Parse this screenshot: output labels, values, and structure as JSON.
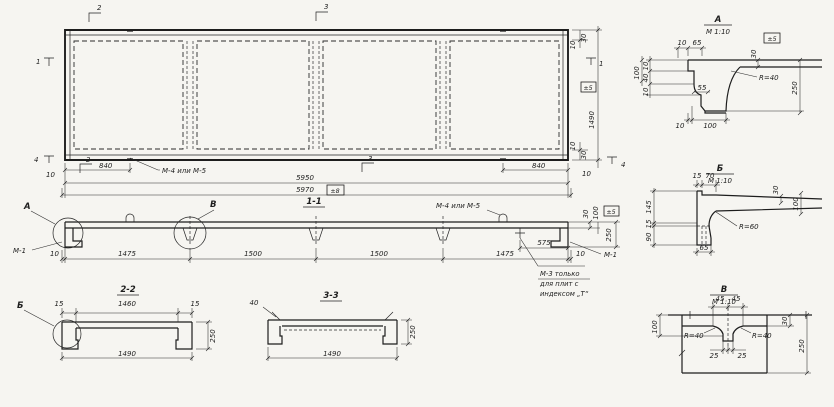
{
  "meta": {
    "drawing_type": "precast ribbed slab working drawing",
    "paper_color": "#f6f5f1",
    "ink_color": "#1e1e1e"
  },
  "plan": {
    "marker_top_2": "2",
    "marker_top_3": "3",
    "marker_bottom_2": "2",
    "marker_bottom_3": "3",
    "marker_left_1": "1",
    "marker_left_4": "4",
    "marker_right_1": "1",
    "marker_right_4": "4",
    "dim_edge_left": "10",
    "dim_840_left": "840",
    "dim_5950": "5950",
    "dim_5970": "5970",
    "tol_5970": "±8",
    "dim_840_right": "840",
    "dim_edge_right": "10",
    "dim_30_top": "30",
    "dim_10_top": "10",
    "dim_1490": "1490",
    "tol_1490": "±5",
    "dim_10_bottom": "10",
    "dim_30_bottom": "30",
    "label_m4m5": "М-4 или М-5"
  },
  "section_1_1": {
    "title": "1-1",
    "detail_ref_a": "А",
    "detail_ref_v": "В",
    "label_m1_left": "М-1",
    "label_m1_right": "М-1",
    "label_m4m5": "М-4 или М-5",
    "note_m3_line1": "М-3 только",
    "note_m3_line2": "для плит с",
    "note_m3_line3": "индексом „Т“",
    "dim_10_left": "10",
    "chain": [
      "1475",
      "1500",
      "1500",
      "1475"
    ],
    "dim_575": "575",
    "dim_10_right": "10",
    "dim_30": "30",
    "dim_100": "100",
    "tol_5": "±5",
    "dim_250": "250"
  },
  "section_2_2": {
    "title": "2-2",
    "detail_ref_b": "Б",
    "dim_15_left": "15",
    "dim_1460": "1460",
    "dim_15_right": "15",
    "dim_250": "250",
    "dim_1490": "1490"
  },
  "section_3_3": {
    "title": "3-3",
    "dim_40": "40",
    "dim_1490": "1490",
    "dim_250": "250"
  },
  "detail_a": {
    "title": "А",
    "scale": "М 1:10",
    "tol": "±5",
    "dim_10_top": "10",
    "dim_65": "65",
    "dim_30": "30",
    "radius": "R=40",
    "dim_100_left": "100",
    "dim_10_a": "10",
    "dim_40": "40",
    "dim_10_b": "10",
    "dim_55": "55",
    "dim_10_bottom": "10",
    "dim_100_bottom": "100",
    "dim_250": "250"
  },
  "detail_b": {
    "title": "Б",
    "scale": "М 1:10",
    "dim_15_top": "15",
    "dim_70": "70",
    "dim_145": "145",
    "dim_15_left": "15",
    "dim_90": "90",
    "dim_30": "30",
    "dim_100": "100",
    "radius": "R=60",
    "dim_65": "65"
  },
  "detail_v": {
    "title": "В",
    "scale": "М 1:10",
    "dim_45_left": "45",
    "dim_45_right": "45",
    "dim_100": "100",
    "radius_left": "R=40",
    "radius_right": "R=40",
    "dim_30": "30",
    "dim_25_left": "25",
    "dim_25_right": "25",
    "dim_250": "250"
  }
}
